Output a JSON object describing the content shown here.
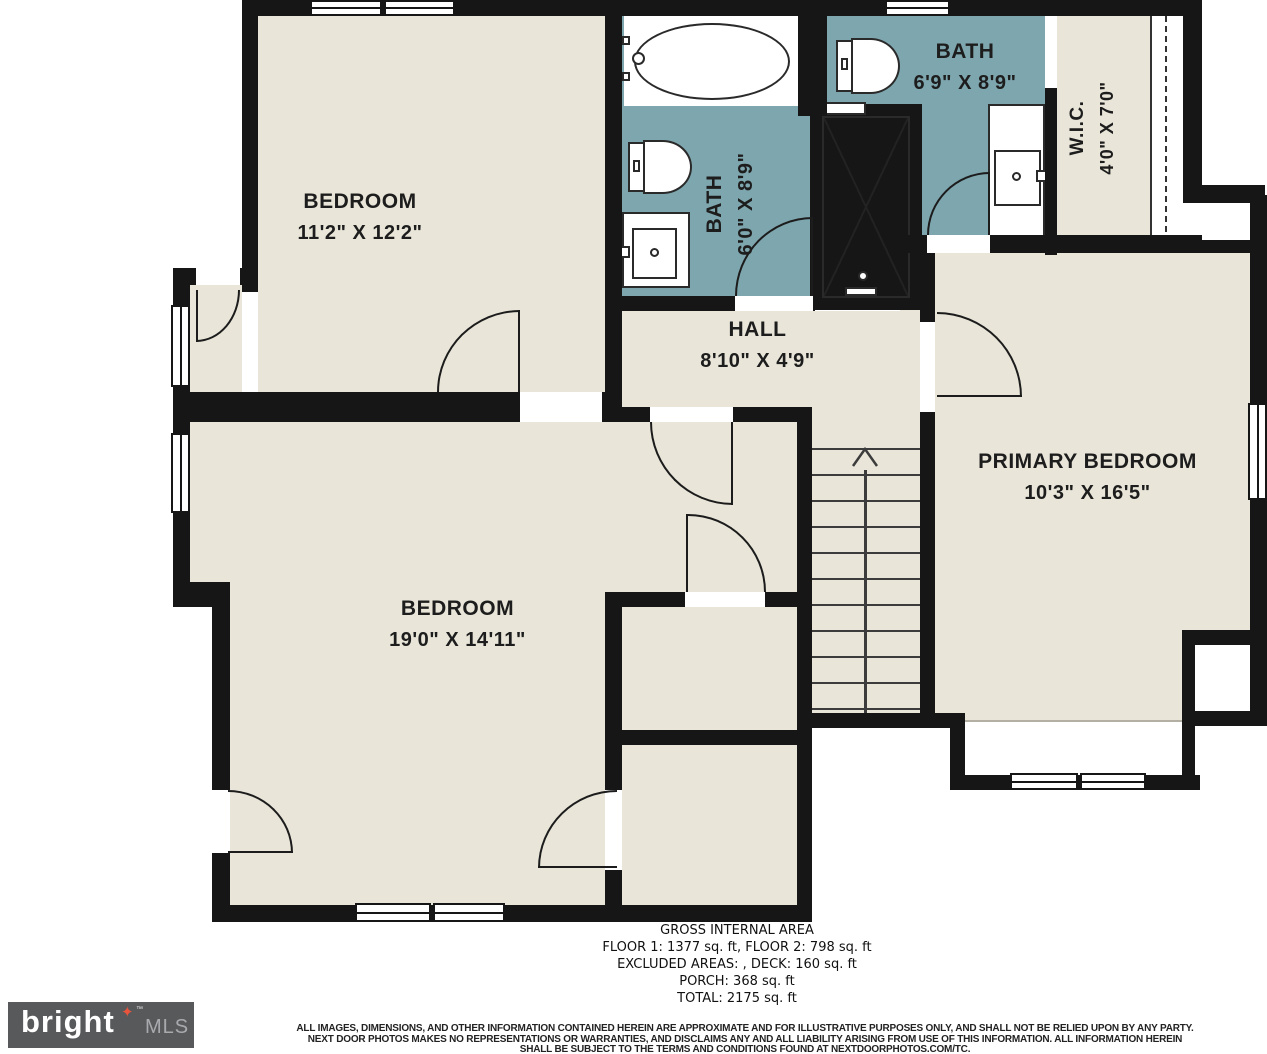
{
  "plan": {
    "rooms": {
      "bedroom_tl": {
        "name": "BEDROOM",
        "dims": "11'2\" X 12'2\""
      },
      "bath1": {
        "name": "BATH",
        "dims": "6'0\" X 8'9\""
      },
      "bath2": {
        "name": "BATH",
        "dims": "6'9\" X 8'9\""
      },
      "wic": {
        "name": "W.I.C.",
        "dims": "4'0\" X 7'0\""
      },
      "hall": {
        "name": "HALL",
        "dims": "8'10\" X 4'9\""
      },
      "bedroom_bl": {
        "name": "BEDROOM",
        "dims": "19'0\" X 14'11\""
      },
      "primary": {
        "name": "PRIMARY BEDROOM",
        "dims": "10'3\" X 16'5\""
      }
    },
    "colors": {
      "wall": "#161616",
      "floor": "#e9e6d9",
      "bath": "#7ea6ae",
      "logo_bg": "#58595b",
      "logo_star": "#e8543c",
      "logo_mls": "#a8aaad"
    }
  },
  "footer": {
    "area_lines": [
      "GROSS INTERNAL AREA",
      "FLOOR 1: 1377 sq. ft, FLOOR 2: 798 sq. ft",
      "EXCLUDED AREAS: , DECK: 160 sq. ft",
      "PORCH: 368 sq. ft",
      "TOTAL: 2175 sq. ft"
    ],
    "disclaimer": [
      "ALL IMAGES, DIMENSIONS, AND OTHER INFORMATION CONTAINED HEREIN ARE APPROXIMATE AND FOR ILLUSTRATIVE PURPOSES ONLY, AND SHALL NOT BE RELIED UPON BY ANY PARTY.",
      "NEXT DOOR PHOTOS MAKES NO REPRESENTATIONS OR WARRANTIES, AND DISCLAIMS ANY AND ALL LIABILITY ARISING FROM USE OF THIS INFORMATION. ALL INFORMATION HEREIN",
      "SHALL BE SUBJECT TO THE TERMS AND CONDITIONS FOUND AT NEXTDOORPHOTOS.COM/TC."
    ]
  },
  "logo": {
    "brand": "bright",
    "star": "✦",
    "tm": "™",
    "suffix": "MLS"
  }
}
